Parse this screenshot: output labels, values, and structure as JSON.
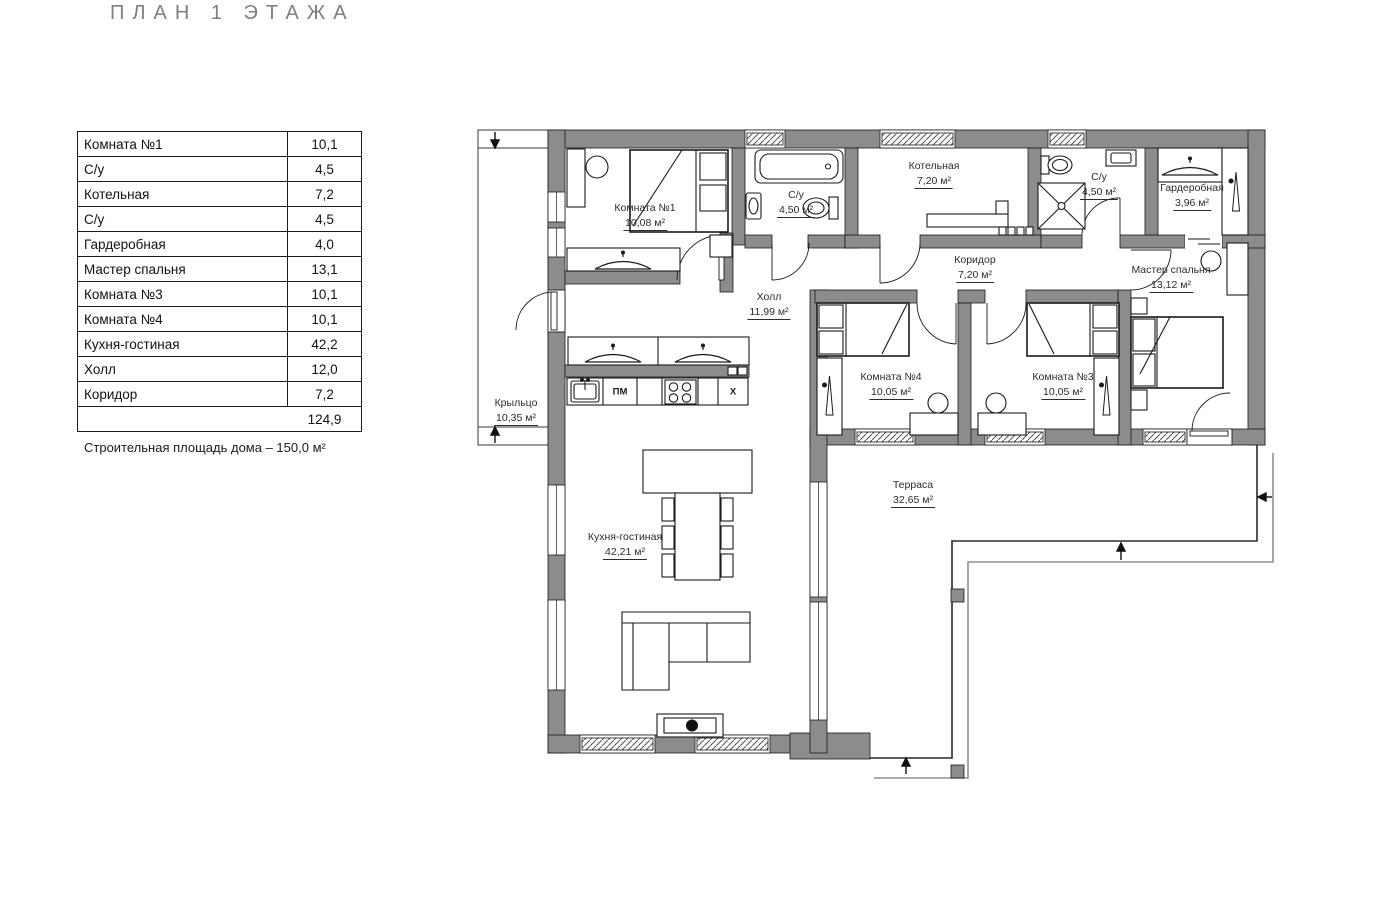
{
  "title": "ПЛАН 1 ЭТАЖА",
  "note": "Строительная площадь дома – 150,0 м²",
  "area_table": {
    "rows": [
      {
        "name": "Комната №1",
        "value": "10,1"
      },
      {
        "name": "С/у",
        "value": "4,5"
      },
      {
        "name": "Котельная",
        "value": "7,2"
      },
      {
        "name": "С/у",
        "value": "4,5"
      },
      {
        "name": "Гардеробная",
        "value": "4,0"
      },
      {
        "name": "Мастер спальня",
        "value": "13,1"
      },
      {
        "name": "Комната №3",
        "value": "10,1"
      },
      {
        "name": "Комната №4",
        "value": "10,1"
      },
      {
        "name": "Кухня-гостиная",
        "value": "42,2"
      },
      {
        "name": "Холл",
        "value": "12,0"
      },
      {
        "name": "Коридор",
        "value": "7,2"
      }
    ],
    "total": "124,9"
  },
  "plan": {
    "rooms": {
      "komnata1": {
        "name": "Комната №1",
        "area": "10,08 м²"
      },
      "su1": {
        "name": "С/у",
        "area": "4,50 м²"
      },
      "kotelnaya": {
        "name": "Котельная",
        "area": "7,20 м²"
      },
      "su2": {
        "name": "С/у",
        "area": "4,50 м²"
      },
      "garderobnaya": {
        "name": "Гардеробная",
        "area": "3,96 м²"
      },
      "koridor": {
        "name": "Коридор",
        "area": "7,20 м²"
      },
      "master": {
        "name": "Мастер спальня",
        "area": "13,12 м²"
      },
      "holl": {
        "name": "Холл",
        "area": "11,99 м²"
      },
      "komnata4": {
        "name": "Комната №4",
        "area": "10,05 м²"
      },
      "komnata3": {
        "name": "Комната №3",
        "area": "10,05 м²"
      },
      "kitchen": {
        "name": "Кухня-гостиная",
        "area": "42,21 м²"
      },
      "kryltso": {
        "name": "Крыльцо",
        "area": "10,35 м²"
      },
      "terrasa": {
        "name": "Терраса",
        "area": "32,65 м²"
      }
    },
    "appliances": {
      "dishwasher": "ПМ",
      "fridge": "Х"
    }
  },
  "colors": {
    "wall": "#8c8c8c",
    "line": "#1a1a1a",
    "title": "#7f7f7f"
  }
}
